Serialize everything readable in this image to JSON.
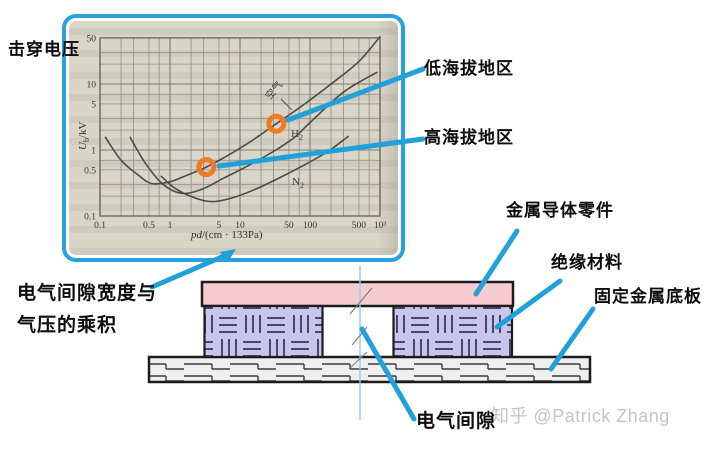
{
  "page": {
    "watermark": "知乎 @Patrick Zhang"
  },
  "labels": {
    "breakdown_voltage": "击穿电压",
    "low_altitude": "低海拔地区",
    "high_altitude": "高海拔地区",
    "clearance_pressure_line1": "电气间隙宽度与",
    "clearance_pressure_line2": "气压的乘积",
    "metal_conductor": "金属导体零件",
    "insulation": "绝缘材料",
    "fixed_metal_plate": "固定金属底板",
    "clearance": "电气间隙"
  },
  "colors": {
    "accent_blue": "#21a0da",
    "marker_orange": "#ee7d22",
    "conductor_pink": "#f8cbd1",
    "insulation_purple": "#c9c5ec",
    "scan_background": "#d8d5c9",
    "watermark_gray": "#c5c5c5"
  },
  "chart_data": {
    "type": "line",
    "title": "",
    "grid": true,
    "legend_position": "inline-curve-labels",
    "x_axis": {
      "label_italic": "pd",
      "label_rest": "/(cm · 133Pa)",
      "scale": "log",
      "min": 0.1,
      "max": 1000,
      "tick_values": [
        0.1,
        0.5,
        1,
        5,
        10,
        50,
        100,
        500,
        1000
      ],
      "tick_labels": [
        "0.1",
        "0.5",
        "1",
        "5",
        "10",
        "50",
        "100",
        "500",
        "10³"
      ]
    },
    "y_axis": {
      "label_italic": "U",
      "label_sub": "b",
      "label_rest": "/kV",
      "scale": "log",
      "min": 0.1,
      "max": 50,
      "tick_values": [
        0.1,
        0.5,
        1,
        5,
        10,
        50
      ],
      "tick_labels": [
        "0.1",
        "0.5",
        "1",
        "5",
        "10",
        "50"
      ]
    },
    "series": [
      {
        "name": "空气",
        "label_main": "空气",
        "points": [
          [
            0.12,
            1.55
          ],
          [
            0.2,
            0.7
          ],
          [
            0.35,
            0.42
          ],
          [
            0.55,
            0.31
          ],
          [
            1,
            0.33
          ],
          [
            1.8,
            0.42
          ],
          [
            3.3,
            0.55
          ],
          [
            7,
            0.85
          ],
          [
            15,
            1.4
          ],
          [
            33,
            2.5
          ],
          [
            80,
            4.8
          ],
          [
            200,
            10
          ],
          [
            500,
            22
          ],
          [
            1000,
            52
          ]
        ]
      },
      {
        "name": "H2",
        "label_main": "H",
        "label_sub": "2",
        "points": [
          [
            0.27,
            1.55
          ],
          [
            0.45,
            0.62
          ],
          [
            0.8,
            0.3
          ],
          [
            1.5,
            0.22
          ],
          [
            3,
            0.26
          ],
          [
            6,
            0.38
          ],
          [
            12,
            0.55
          ],
          [
            30,
            0.95
          ],
          [
            60,
            1.55
          ],
          [
            100,
            2.6
          ],
          [
            300,
            7.5
          ],
          [
            900,
            15
          ]
        ]
      },
      {
        "name": "N2",
        "label_main": "N",
        "label_sub": "2",
        "points": [
          [
            0.75,
            0.4
          ],
          [
            1.2,
            0.26
          ],
          [
            2.2,
            0.19
          ],
          [
            4,
            0.165
          ],
          [
            8,
            0.19
          ],
          [
            16,
            0.25
          ],
          [
            35,
            0.37
          ],
          [
            80,
            0.58
          ],
          [
            180,
            0.95
          ],
          [
            350,
            1.6
          ]
        ]
      }
    ],
    "markers": [
      {
        "linked_label": "高海拔地区",
        "x": 3.3,
        "y": 0.55
      },
      {
        "linked_label": "低海拔地区",
        "x": 33,
        "y": 2.5
      }
    ]
  }
}
